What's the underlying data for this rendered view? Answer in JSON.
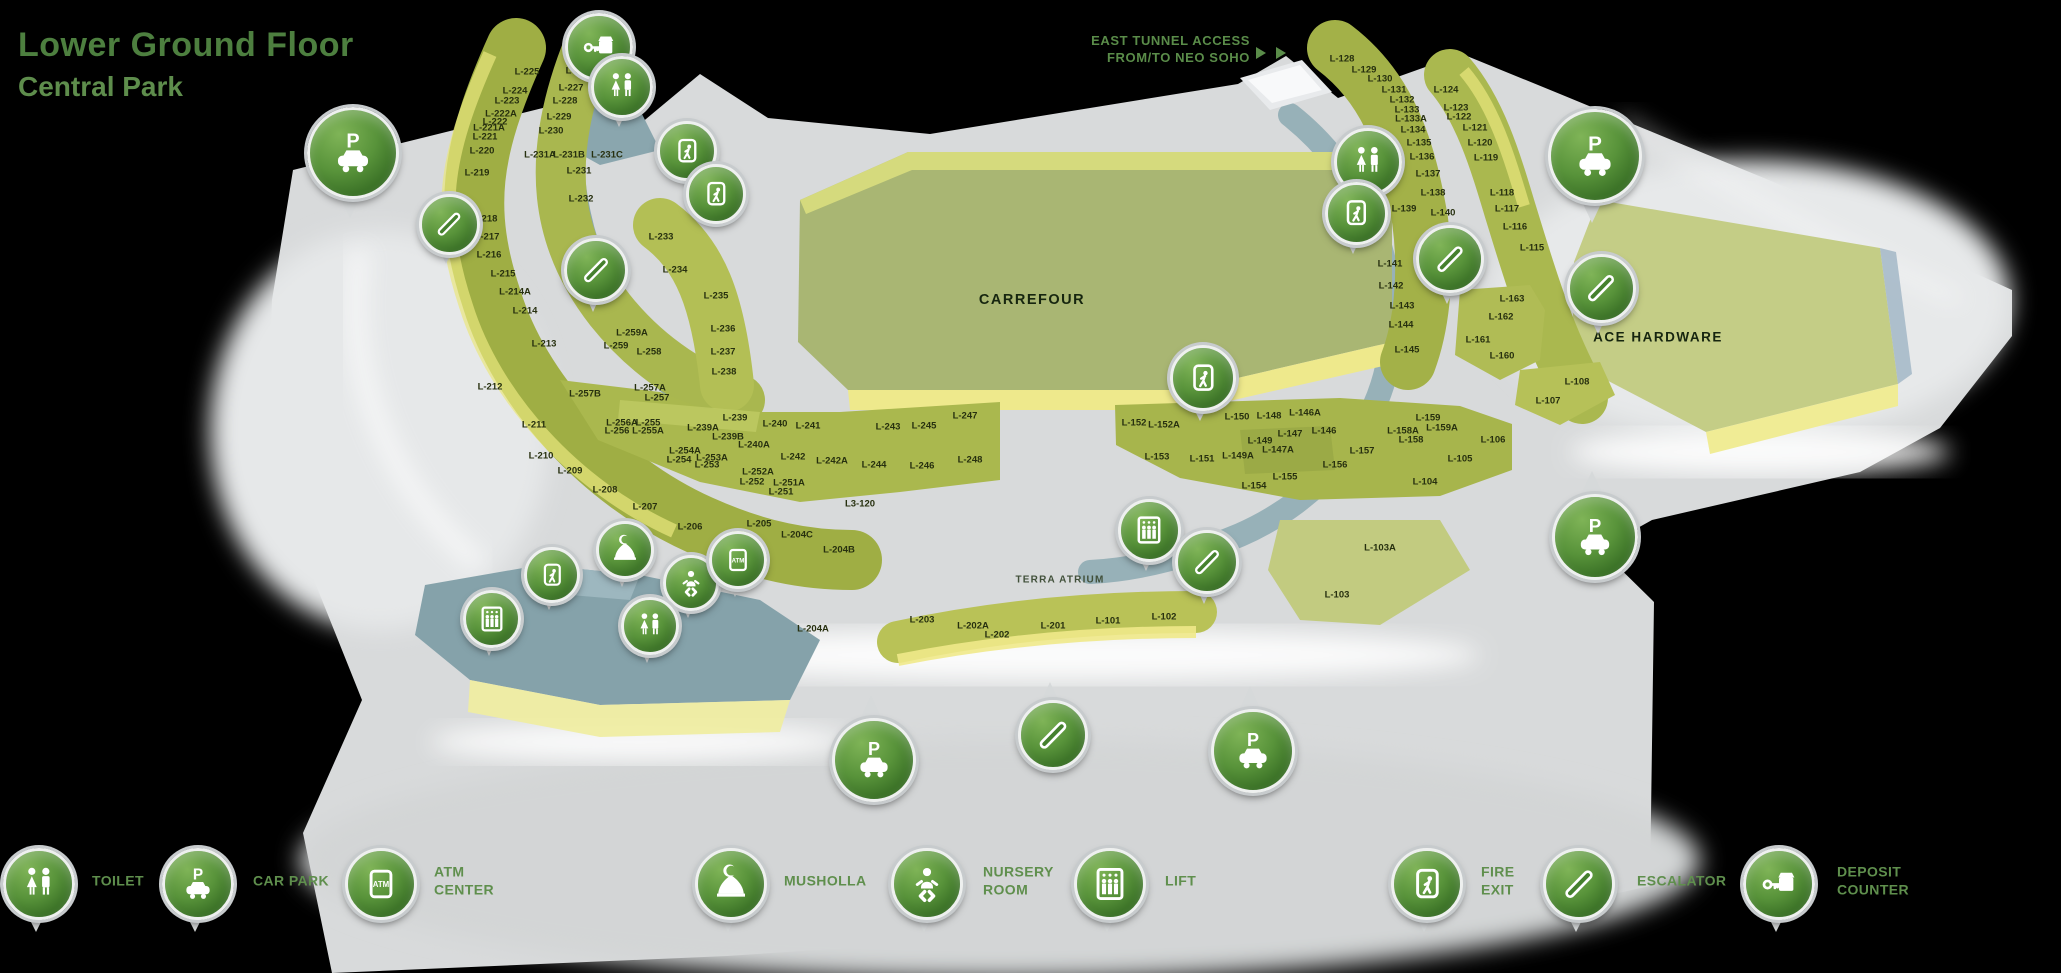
{
  "title": {
    "line1": "Lower Ground Floor",
    "line2": "Central Park"
  },
  "annotations": {
    "east_tunnel": "EAST TUNNEL ACCESS\nFROM/TO NEO SOHO",
    "terra_atrium": "TERRA ATRIUM"
  },
  "anchors": {
    "carrefour": "CARREFOUR",
    "ace_hardware": "ACE HARDWARE"
  },
  "colors": {
    "background": "#000000",
    "title_green": "#4d7f3f",
    "subtitle_green": "#5e8d4c",
    "legend_text_green": "#5f8f4d",
    "pin_green": "#4e8a33",
    "floor_gray": "#d8dadb",
    "block_olive": "#a4b248",
    "block_yellow": "#ece98c",
    "walkway_teal": "#7f9fa9",
    "unit_label": "#27300f"
  },
  "units": [
    {
      "id": "L-225",
      "x": 527,
      "y": 72
    },
    {
      "id": "L-224",
      "x": 515,
      "y": 91
    },
    {
      "id": "L-223",
      "x": 507,
      "y": 101
    },
    {
      "id": "L-222A",
      "x": 501,
      "y": 114
    },
    {
      "id": "L-222",
      "x": 495,
      "y": 122
    },
    {
      "id": "L-221A",
      "x": 489,
      "y": 128
    },
    {
      "id": "L-221",
      "x": 485,
      "y": 137
    },
    {
      "id": "L-220",
      "x": 482,
      "y": 151
    },
    {
      "id": "L-219",
      "x": 477,
      "y": 173
    },
    {
      "id": "L-218",
      "x": 485,
      "y": 219
    },
    {
      "id": "L-217",
      "x": 487,
      "y": 237
    },
    {
      "id": "L-216",
      "x": 489,
      "y": 255
    },
    {
      "id": "L-215",
      "x": 503,
      "y": 274
    },
    {
      "id": "L-214A",
      "x": 515,
      "y": 292
    },
    {
      "id": "L-214",
      "x": 525,
      "y": 311
    },
    {
      "id": "L-213",
      "x": 544,
      "y": 344
    },
    {
      "id": "L-212",
      "x": 490,
      "y": 387
    },
    {
      "id": "L-211",
      "x": 534,
      "y": 425
    },
    {
      "id": "L-210",
      "x": 541,
      "y": 456
    },
    {
      "id": "L-209",
      "x": 570,
      "y": 471
    },
    {
      "id": "L-208",
      "x": 605,
      "y": 490
    },
    {
      "id": "L-207",
      "x": 645,
      "y": 507
    },
    {
      "id": "L-206",
      "x": 690,
      "y": 527
    },
    {
      "id": "L-205",
      "x": 759,
      "y": 524
    },
    {
      "id": "L-204C",
      "x": 797,
      "y": 535
    },
    {
      "id": "L-204B",
      "x": 839,
      "y": 550
    },
    {
      "id": "L-204A",
      "x": 813,
      "y": 629
    },
    {
      "id": "L-226",
      "x": 578,
      "y": 71
    },
    {
      "id": "L-227",
      "x": 571,
      "y": 88
    },
    {
      "id": "L-228",
      "x": 565,
      "y": 101
    },
    {
      "id": "L-229",
      "x": 559,
      "y": 117
    },
    {
      "id": "L-230",
      "x": 551,
      "y": 131
    },
    {
      "id": "L-231A",
      "x": 540,
      "y": 155
    },
    {
      "id": "L-231B",
      "x": 569,
      "y": 155
    },
    {
      "id": "L-231C",
      "x": 607,
      "y": 155
    },
    {
      "id": "L-231",
      "x": 579,
      "y": 171
    },
    {
      "id": "L-232",
      "x": 581,
      "y": 199
    },
    {
      "id": "L-233",
      "x": 661,
      "y": 237
    },
    {
      "id": "L-234",
      "x": 675,
      "y": 270
    },
    {
      "id": "L-235",
      "x": 716,
      "y": 296
    },
    {
      "id": "L-236",
      "x": 723,
      "y": 329
    },
    {
      "id": "L-237",
      "x": 723,
      "y": 352
    },
    {
      "id": "L-238",
      "x": 724,
      "y": 372
    },
    {
      "id": "L-259A",
      "x": 632,
      "y": 333
    },
    {
      "id": "L-259",
      "x": 616,
      "y": 346
    },
    {
      "id": "L-258",
      "x": 649,
      "y": 352
    },
    {
      "id": "L-257B",
      "x": 585,
      "y": 394
    },
    {
      "id": "L-257A",
      "x": 650,
      "y": 388
    },
    {
      "id": "L-257",
      "x": 657,
      "y": 398
    },
    {
      "id": "L-256A",
      "x": 622,
      "y": 423
    },
    {
      "id": "L-256",
      "x": 617,
      "y": 431
    },
    {
      "id": "L-255",
      "x": 648,
      "y": 423
    },
    {
      "id": "L-255A",
      "x": 648,
      "y": 431
    },
    {
      "id": "L-254A",
      "x": 685,
      "y": 451
    },
    {
      "id": "L-254",
      "x": 679,
      "y": 460
    },
    {
      "id": "L-253A",
      "x": 712,
      "y": 458
    },
    {
      "id": "L-253",
      "x": 707,
      "y": 465
    },
    {
      "id": "L-252A",
      "x": 758,
      "y": 472
    },
    {
      "id": "L-252",
      "x": 752,
      "y": 482
    },
    {
      "id": "L-251A",
      "x": 789,
      "y": 483
    },
    {
      "id": "L-251",
      "x": 781,
      "y": 492
    },
    {
      "id": "L-239",
      "x": 735,
      "y": 418
    },
    {
      "id": "L-239A",
      "x": 703,
      "y": 428
    },
    {
      "id": "L-239B",
      "x": 728,
      "y": 437
    },
    {
      "id": "L-240",
      "x": 775,
      "y": 424
    },
    {
      "id": "L-240A",
      "x": 754,
      "y": 445
    },
    {
      "id": "L-241",
      "x": 808,
      "y": 426
    },
    {
      "id": "L-242",
      "x": 793,
      "y": 457
    },
    {
      "id": "L-242A",
      "x": 832,
      "y": 461
    },
    {
      "id": "L-243",
      "x": 888,
      "y": 427
    },
    {
      "id": "L-244",
      "x": 874,
      "y": 465
    },
    {
      "id": "L-245",
      "x": 924,
      "y": 426
    },
    {
      "id": "L-246",
      "x": 922,
      "y": 466
    },
    {
      "id": "L-247",
      "x": 965,
      "y": 416
    },
    {
      "id": "L-248",
      "x": 970,
      "y": 460
    },
    {
      "id": "L3-120",
      "x": 860,
      "y": 504
    },
    {
      "id": "L-203",
      "x": 922,
      "y": 620
    },
    {
      "id": "L-202A",
      "x": 973,
      "y": 626
    },
    {
      "id": "L-202",
      "x": 997,
      "y": 635
    },
    {
      "id": "L-201",
      "x": 1053,
      "y": 626
    },
    {
      "id": "L-101",
      "x": 1108,
      "y": 621
    },
    {
      "id": "L-102",
      "x": 1164,
      "y": 617
    },
    {
      "id": "L-103",
      "x": 1337,
      "y": 595
    },
    {
      "id": "L-103A",
      "x": 1380,
      "y": 548
    },
    {
      "id": "L-152",
      "x": 1134,
      "y": 423
    },
    {
      "id": "L-152A",
      "x": 1164,
      "y": 425
    },
    {
      "id": "L-153",
      "x": 1157,
      "y": 457
    },
    {
      "id": "L-151",
      "x": 1202,
      "y": 459
    },
    {
      "id": "L-150",
      "x": 1237,
      "y": 417
    },
    {
      "id": "L-149",
      "x": 1260,
      "y": 441
    },
    {
      "id": "L-149A",
      "x": 1238,
      "y": 456
    },
    {
      "id": "L-148",
      "x": 1269,
      "y": 416
    },
    {
      "id": "L-147",
      "x": 1290,
      "y": 434
    },
    {
      "id": "L-147A",
      "x": 1278,
      "y": 450
    },
    {
      "id": "L-146A",
      "x": 1305,
      "y": 413
    },
    {
      "id": "L-146",
      "x": 1324,
      "y": 431
    },
    {
      "id": "L-154",
      "x": 1254,
      "y": 486
    },
    {
      "id": "L-155",
      "x": 1285,
      "y": 477
    },
    {
      "id": "L-156",
      "x": 1335,
      "y": 465
    },
    {
      "id": "L-157",
      "x": 1362,
      "y": 451
    },
    {
      "id": "L-158A",
      "x": 1403,
      "y": 431
    },
    {
      "id": "L-158",
      "x": 1411,
      "y": 440
    },
    {
      "id": "L-159",
      "x": 1428,
      "y": 418
    },
    {
      "id": "L-159A",
      "x": 1442,
      "y": 428
    },
    {
      "id": "L-104",
      "x": 1425,
      "y": 482
    },
    {
      "id": "L-105",
      "x": 1460,
      "y": 459
    },
    {
      "id": "L-106",
      "x": 1493,
      "y": 440
    },
    {
      "id": "L-128",
      "x": 1342,
      "y": 59
    },
    {
      "id": "L-129",
      "x": 1364,
      "y": 70
    },
    {
      "id": "L-130",
      "x": 1380,
      "y": 79
    },
    {
      "id": "L-131",
      "x": 1394,
      "y": 90
    },
    {
      "id": "L-132",
      "x": 1402,
      "y": 100
    },
    {
      "id": "L-133",
      "x": 1407,
      "y": 110
    },
    {
      "id": "L-133A",
      "x": 1411,
      "y": 119
    },
    {
      "id": "L-134",
      "x": 1413,
      "y": 130
    },
    {
      "id": "L-135",
      "x": 1419,
      "y": 143
    },
    {
      "id": "L-136",
      "x": 1422,
      "y": 157
    },
    {
      "id": "L-137",
      "x": 1428,
      "y": 174
    },
    {
      "id": "L-138",
      "x": 1433,
      "y": 193
    },
    {
      "id": "L-139",
      "x": 1404,
      "y": 209
    },
    {
      "id": "L-140",
      "x": 1443,
      "y": 213
    },
    {
      "id": "L-141",
      "x": 1390,
      "y": 264
    },
    {
      "id": "L-142",
      "x": 1391,
      "y": 286
    },
    {
      "id": "L-143",
      "x": 1402,
      "y": 306
    },
    {
      "id": "L-144",
      "x": 1401,
      "y": 325
    },
    {
      "id": "L-145",
      "x": 1407,
      "y": 350
    },
    {
      "id": "L-124",
      "x": 1446,
      "y": 90
    },
    {
      "id": "L-123",
      "x": 1456,
      "y": 108
    },
    {
      "id": "L-122",
      "x": 1459,
      "y": 117
    },
    {
      "id": "L-121",
      "x": 1475,
      "y": 128
    },
    {
      "id": "L-120",
      "x": 1480,
      "y": 143
    },
    {
      "id": "L-119",
      "x": 1486,
      "y": 158
    },
    {
      "id": "L-118",
      "x": 1502,
      "y": 193
    },
    {
      "id": "L-117",
      "x": 1507,
      "y": 209
    },
    {
      "id": "L-116",
      "x": 1515,
      "y": 227
    },
    {
      "id": "L-115",
      "x": 1532,
      "y": 248
    },
    {
      "id": "L-163",
      "x": 1512,
      "y": 299
    },
    {
      "id": "L-162",
      "x": 1501,
      "y": 317
    },
    {
      "id": "L-161",
      "x": 1478,
      "y": 340
    },
    {
      "id": "L-160",
      "x": 1502,
      "y": 356
    },
    {
      "id": "L-108",
      "x": 1577,
      "y": 382
    },
    {
      "id": "L-107",
      "x": 1548,
      "y": 401
    }
  ],
  "pins": [
    {
      "icon": "carpark",
      "x": 350,
      "y": 150,
      "d": 86,
      "tail": "down"
    },
    {
      "icon": "escalator",
      "x": 446,
      "y": 221,
      "d": 55,
      "tail": "down"
    },
    {
      "icon": "deposit",
      "x": 596,
      "y": 44,
      "d": 62,
      "tail": "down"
    },
    {
      "icon": "toilet",
      "x": 619,
      "y": 84,
      "d": 56,
      "tail": "down"
    },
    {
      "icon": "fireexit",
      "x": 684,
      "y": 148,
      "d": 54,
      "tail": "down"
    },
    {
      "icon": "fireexit",
      "x": 713,
      "y": 191,
      "d": 54,
      "tail": "down"
    },
    {
      "icon": "escalator",
      "x": 593,
      "y": 267,
      "d": 58,
      "tail": "down"
    },
    {
      "icon": "toilet",
      "x": 1365,
      "y": 159,
      "d": 62,
      "tail": "down"
    },
    {
      "icon": "fireexit",
      "x": 1353,
      "y": 210,
      "d": 57,
      "tail": "down"
    },
    {
      "icon": "escalator",
      "x": 1447,
      "y": 256,
      "d": 62,
      "tail": "down"
    },
    {
      "icon": "escalator",
      "x": 1598,
      "y": 285,
      "d": 63,
      "tail": "down"
    },
    {
      "icon": "carpark",
      "x": 1592,
      "y": 153,
      "d": 88,
      "tail": "down"
    },
    {
      "icon": "fireexit",
      "x": 1200,
      "y": 375,
      "d": 60,
      "tail": "down"
    },
    {
      "icon": "lift",
      "x": 1146,
      "y": 527,
      "d": 57,
      "tail": "down"
    },
    {
      "icon": "escalator",
      "x": 1204,
      "y": 559,
      "d": 58,
      "tail": "down"
    },
    {
      "icon": "musholla",
      "x": 622,
      "y": 547,
      "d": 52,
      "tail": "down"
    },
    {
      "icon": "nursery",
      "x": 688,
      "y": 580,
      "d": 50,
      "tail": "down"
    },
    {
      "icon": "atm",
      "x": 735,
      "y": 557,
      "d": 52,
      "tail": "down"
    },
    {
      "icon": "toilet",
      "x": 647,
      "y": 623,
      "d": 52,
      "tail": "down"
    },
    {
      "icon": "fireexit",
      "x": 549,
      "y": 572,
      "d": 50,
      "tail": "down"
    },
    {
      "icon": "lift",
      "x": 489,
      "y": 616,
      "d": 52,
      "tail": "down"
    },
    {
      "icon": "carpark",
      "x": 871,
      "y": 757,
      "d": 78,
      "tail": "up"
    },
    {
      "icon": "escalator",
      "x": 1050,
      "y": 732,
      "d": 64,
      "tail": "up"
    },
    {
      "icon": "carpark",
      "x": 1250,
      "y": 748,
      "d": 78,
      "tail": "up"
    },
    {
      "icon": "carpark",
      "x": 1592,
      "y": 534,
      "d": 80,
      "tail": "up"
    }
  ],
  "legend": [
    {
      "icon": "toilet",
      "label": "TOILET",
      "px": 36,
      "lx": 92
    },
    {
      "icon": "carpark",
      "label": "CAR PARK",
      "px": 195,
      "lx": 253
    },
    {
      "icon": "atm",
      "label": "ATM\nCENTER",
      "px": 378,
      "lx": 434
    },
    {
      "icon": "musholla",
      "label": "MUSHOLLA",
      "px": 728,
      "lx": 784
    },
    {
      "icon": "nursery",
      "label": "NURSERY\nROOM",
      "px": 924,
      "lx": 983
    },
    {
      "icon": "lift",
      "label": "LIFT",
      "px": 1107,
      "lx": 1165
    },
    {
      "icon": "fireexit",
      "label": "FIRE\nEXIT",
      "px": 1424,
      "lx": 1481
    },
    {
      "icon": "escalator",
      "label": "ESCALATOR",
      "px": 1576,
      "lx": 1637
    },
    {
      "icon": "deposit",
      "label": "DEPOSIT\nCOUNTER",
      "px": 1776,
      "lx": 1837
    }
  ]
}
